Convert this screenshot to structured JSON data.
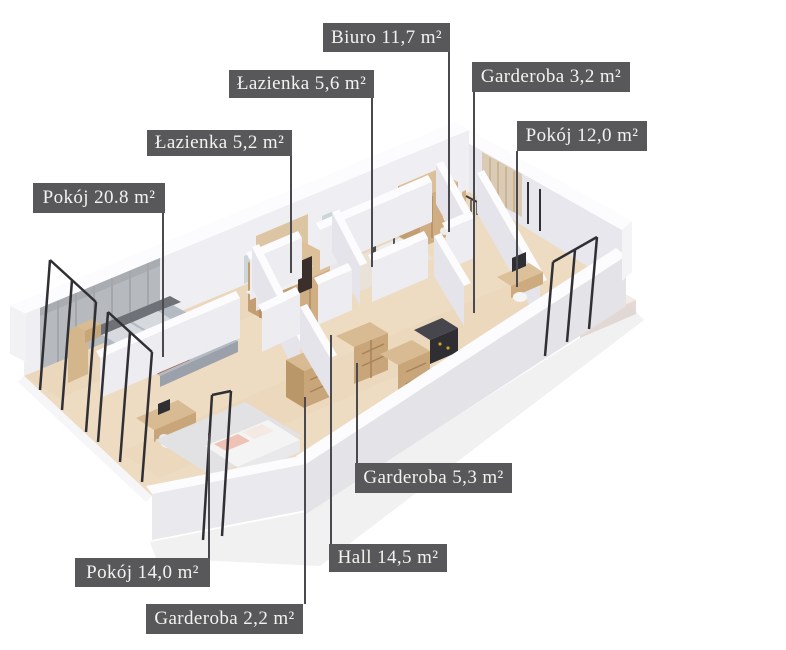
{
  "scene": {
    "type": "3d-isometric-floorplan-render",
    "background": "#ffffff",
    "units": "m²"
  },
  "rooms": [
    {
      "id": "biuro",
      "label": "Biuro 11,7 m²"
    },
    {
      "id": "lazienka-5-6",
      "label": "Łazienka 5,6 m²"
    },
    {
      "id": "garderoba-3-2",
      "label": "Garderoba 3,2 m²"
    },
    {
      "id": "pokoj-12-0",
      "label": "Pokój 12,0 m²"
    },
    {
      "id": "lazienka-5-2",
      "label": "Łazienka 5,2 m²"
    },
    {
      "id": "pokoj-20-8",
      "label": "Pokój 20.8 m²"
    },
    {
      "id": "garderoba-5-3",
      "label": "Garderoba 5,3 m²"
    },
    {
      "id": "hall-14-5",
      "label": "Hall 14,5 m²"
    },
    {
      "id": "pokoj-14-0",
      "label": "Pokój 14,0 m²"
    },
    {
      "id": "garderoba-2-2",
      "label": "Garderoba 2,2 m²"
    }
  ],
  "colors": {
    "label_background": "#58585b",
    "label_text": "#f3f2f0",
    "leader_line": "#4a4a4e",
    "floor_wood": "#eedcc2",
    "bath_floor": "#e9e2d8",
    "wall_top": "#fcfcfe",
    "wall_face_light": "#efeff3",
    "wall_face_shade": "#e4e4ea",
    "furniture_wood": "#d8bb92",
    "window_frame": "#2f2f34",
    "bed_gray": "#b3bac2",
    "throw_brown": "#a2583a"
  }
}
